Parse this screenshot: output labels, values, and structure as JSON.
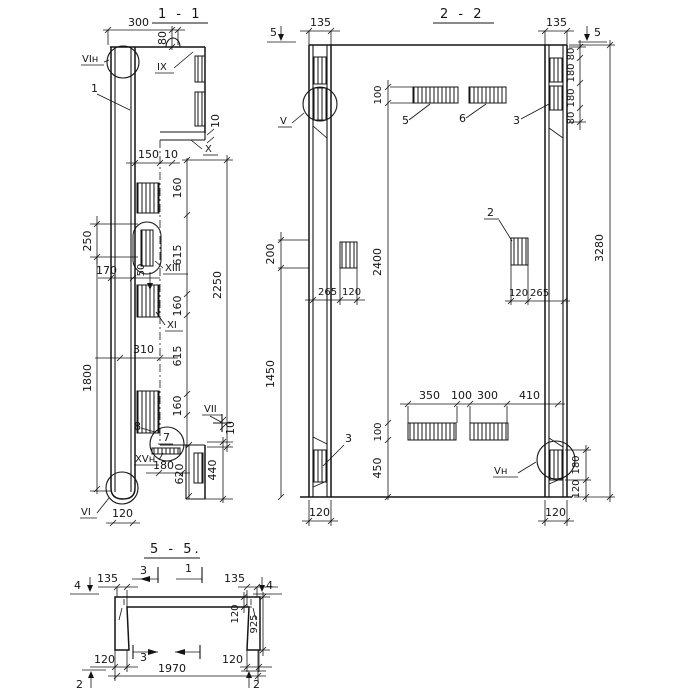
{
  "section_1_1": {
    "title": "1 - 1",
    "dims": {
      "top_width": "300",
      "top_offset": "80",
      "step_10": "10",
      "w150": "150",
      "w10": "10",
      "v160a": "160",
      "v615a": "615",
      "v160b": "160",
      "v615b": "615",
      "v160c": "160",
      "v2250": "2250",
      "left_250": "250",
      "left_170": "170",
      "small_50": "50",
      "h310": "310",
      "left_1800": "1800",
      "w180": "180",
      "v620": "620",
      "v440": "440",
      "b10": "10",
      "b120": "120"
    },
    "nodes": {
      "vi_n": "VIн",
      "ix": "IX",
      "x": "X",
      "xiii": "XIII",
      "xi": "XI",
      "vii": "VII",
      "xv_n": "XVн",
      "vi": "VI"
    },
    "parts": {
      "p1": "1",
      "p7": "7",
      "p8": "8"
    }
  },
  "section_2_2": {
    "title": "2 - 2",
    "cut_marks": {
      "left5": "5",
      "right5": "5"
    },
    "dims": {
      "l135": "135",
      "r135": "135",
      "r80a": "80",
      "r180a": "180",
      "r180b": "180",
      "r80b": "80",
      "total_3280": "3280",
      "top_100": "100",
      "l200": "200",
      "l1450": "1450",
      "mid_2400": "2400",
      "c265": "265",
      "c120": "120",
      "r120": "120",
      "r265": "265",
      "b350": "350",
      "b100": "100",
      "b300": "300",
      "b410": "410",
      "bot_100": "100",
      "bot_450": "450",
      "br180": "180",
      "br120": "120",
      "foot_l120": "120",
      "foot_r120": "120"
    },
    "nodes": {
      "v": "V",
      "v_n": "Vн"
    },
    "parts": {
      "p5": "5",
      "p6": "6",
      "p3a": "3",
      "p2": "2",
      "p3b": "3"
    }
  },
  "section_5_5": {
    "title": "5 - 5.",
    "cut_marks": {
      "l4": "4",
      "r4": "4",
      "t3": "3",
      "t1": "1",
      "b3": "3",
      "bl2": "2",
      "br2": "2"
    },
    "dims": {
      "l135": "135",
      "r135": "135",
      "r120": "120",
      "r925": "925",
      "bl120": "120",
      "br120": "120",
      "total_1970": "1970"
    }
  }
}
